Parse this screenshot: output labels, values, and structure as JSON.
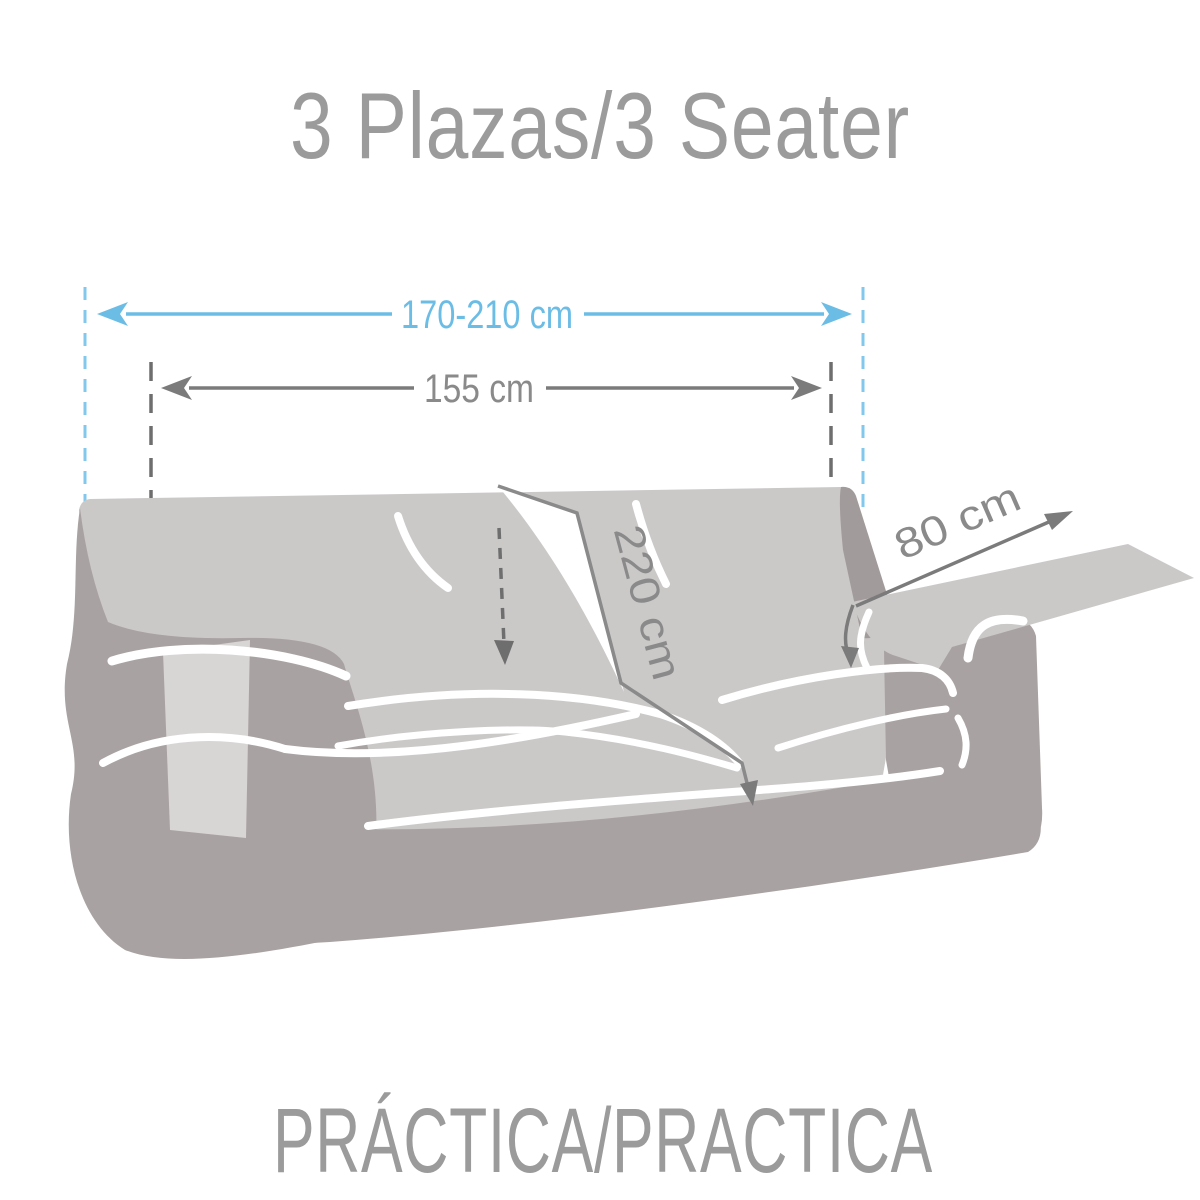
{
  "title": "3 Plazas/3 Seater",
  "footer": "PRÁCTICA/PRACTICA",
  "measurements": {
    "total_width": "170-210 cm",
    "fitted_width": "155 cm",
    "length": "220 cm",
    "arm_flap": "80 cm"
  },
  "colors": {
    "accent_blue": "#6cbde6",
    "accent_blue_dash": "#82c8ec",
    "annotation_gray": "#8a8a8a",
    "annotation_dark_gray": "#6e6e6e",
    "sofa_cover_gray": "#cbc8c8",
    "sofa_body_gray": "#a9a2a2",
    "sofa_flap_gray": "#d8d5d5",
    "heading_text_gray": "#9b9b9b"
  }
}
